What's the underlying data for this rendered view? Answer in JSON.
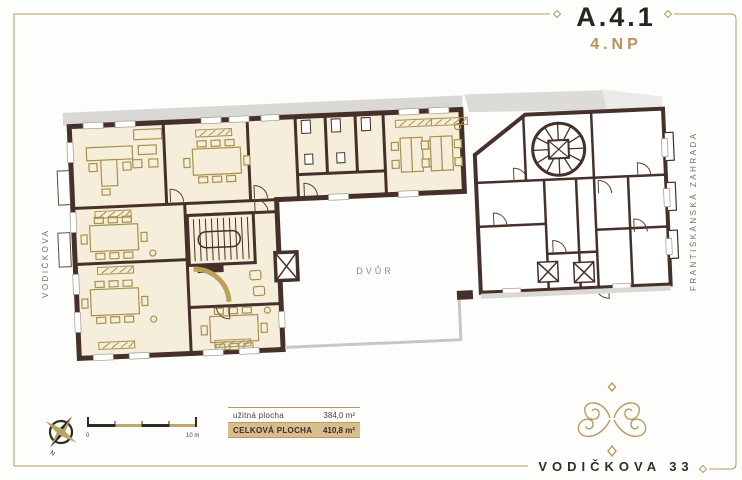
{
  "sheet": {
    "unit_code": "A.4.1",
    "floor": "4.NP",
    "building_name": "VODIČKOVA 33"
  },
  "plan": {
    "street_label": "VODIČKOVA",
    "garden_label": "FRANTIŠKÁNSKÁ ZAHRADA",
    "courtyard_label": "DVŮR"
  },
  "area_table": {
    "rows": [
      {
        "label": "užitná plocha",
        "value": "384,0 m²",
        "highlight": false
      },
      {
        "label": "CELKOVÁ PLOCHA",
        "value": "410,8 m²",
        "highlight": true
      }
    ]
  },
  "scale_bar": {
    "start_label": "0",
    "end_label": "10 m"
  },
  "compass": {
    "north_label": "N"
  },
  "colors": {
    "wall": "#46302a",
    "room_fill": "#f5eedb",
    "furniture": "#a8914c",
    "accent_gold": "#b99a63",
    "highlight_row": "#d9bd8e",
    "gray_shadow": "#d9d8d4",
    "courtyard_line": "#c8c7c3",
    "title_text": "#2a2320",
    "muted_text": "#7b6d62"
  }
}
